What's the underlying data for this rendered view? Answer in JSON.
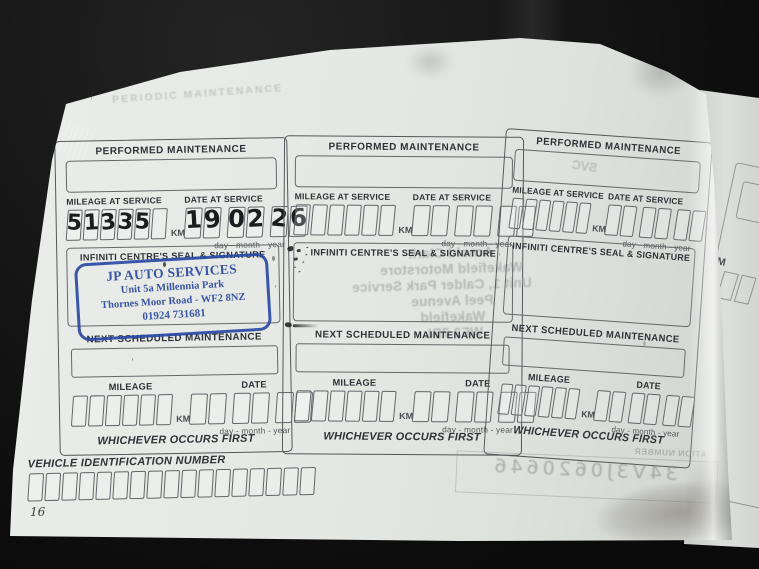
{
  "colors": {
    "stamp_blue": "#2a49a6",
    "page_paper": "#e5e8e4",
    "background": "#0d0d0d",
    "print_ink": "#2f3336"
  },
  "labels": {
    "performed_maintenance": "PERFORMED MAINTENANCE",
    "mileage_at_service": "MILEAGE AT SERVICE",
    "date_at_service": "DATE AT SERVICE",
    "km": "KM",
    "day_month_year": "day - month - year",
    "seal_signature": "INFINITI CENTRE'S SEAL & SIGNATURE",
    "next_scheduled": "NEXT SCHEDULED MAINTENANCE",
    "mileage": "MILEAGE",
    "date": "DATE",
    "whichever": "WHICHEVER OCCURS FIRST"
  },
  "panels": [
    {
      "mileage_digits": [
        "5",
        "1",
        "3",
        "3",
        "5",
        ""
      ],
      "date_digits": [
        "1",
        "9",
        "0",
        "2",
        "2",
        "6"
      ],
      "stamp": {
        "line1": "JP AUTO SERVICES",
        "line2": "Unit 5a Millennia Park",
        "line3": "Thornes Moor Road - WF2 8NZ",
        "line4": "01924 731681"
      }
    },
    {
      "showthrough_lines": [
        "Arnold Clark",
        "Wakefield Motorstore",
        "Unit 1, Calder Park Service",
        "Peel Avenue",
        "Wakefield",
        "WF2 7BL"
      ]
    },
    {
      "faint_text": "SVC"
    }
  ],
  "footer": {
    "vin_label": "VEHICLE IDENTIFICATION NUMBER",
    "page_number": "16"
  },
  "showthrough": {
    "top_text": "PERIODIC MAINTENANCE",
    "bottom_fragment": "ATION NUMBER",
    "bottom_vin": "34V3J0620646"
  },
  "next_page": {
    "mileage_fragment": "M"
  }
}
